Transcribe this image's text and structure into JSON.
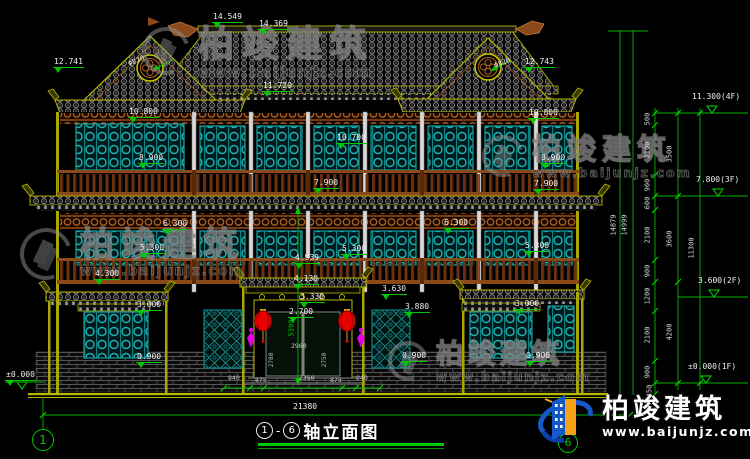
{
  "palette": {
    "background": "#000000",
    "line_green": "#00c800",
    "line_olive": "#b8b800",
    "text_white": "#ffffff",
    "window_teal": "#1db4b4",
    "wood_brown": "#8a4a1a",
    "lantern_red": "#e60000",
    "ornament_magenta": "#e000e0",
    "logo_blue": "#1558c8",
    "logo_orange": "#f5a21a"
  },
  "title": {
    "axis_start": "1",
    "separator": "-",
    "axis_end": "6",
    "label": "轴立面图"
  },
  "axes": {
    "left_label": "1",
    "right_label": "6"
  },
  "watermark": {
    "brand": "柏竣建筑",
    "url": "www.baijunjz.com"
  },
  "logo": {
    "brand": "柏竣建筑",
    "url": "www.baijunjz.com"
  },
  "annotations": [
    {
      "name": "dim-14549",
      "text": "14.549",
      "x": 212,
      "y": 13,
      "cls": "lvl"
    },
    {
      "name": "dim-14369",
      "text": "14.369",
      "x": 258,
      "y": 20,
      "cls": "lvl"
    },
    {
      "name": "dim-12741",
      "text": "12.741",
      "x": 53,
      "y": 58,
      "cls": "lvl"
    },
    {
      "name": "dim-phi820-left",
      "text": "Φ820",
      "x": 128,
      "y": 58,
      "cls": "rot20"
    },
    {
      "name": "dim-phi820-right",
      "text": "Φ820",
      "x": 494,
      "y": 60,
      "cls": "rot20"
    },
    {
      "name": "dim-12743",
      "text": "12.743",
      "x": 524,
      "y": 58,
      "cls": "lvl"
    },
    {
      "name": "dim-11720",
      "text": "11.720",
      "x": 262,
      "y": 82,
      "cls": "lvl"
    },
    {
      "name": "dim-10800-left",
      "text": "10.800",
      "x": 128,
      "y": 108,
      "cls": "lvl"
    },
    {
      "name": "dim-10700",
      "text": "10.700",
      "x": 336,
      "y": 134,
      "cls": "lvl"
    },
    {
      "name": "dim-10800-right",
      "text": "10.800",
      "x": 528,
      "y": 109,
      "cls": "lvl"
    },
    {
      "name": "dim-8900-left",
      "text": "8.900",
      "x": 138,
      "y": 154,
      "cls": "lvl"
    },
    {
      "name": "dim-8900-right",
      "text": "8.900",
      "x": 540,
      "y": 154,
      "cls": "lvl"
    },
    {
      "name": "dim-7900-left",
      "text": "7.900",
      "x": 313,
      "y": 179,
      "cls": "lvl"
    },
    {
      "name": "dim-7900-right",
      "text": "7.900",
      "x": 533,
      "y": 180,
      "cls": "lvl"
    },
    {
      "name": "dim-6300-left",
      "text": "6.300",
      "x": 162,
      "y": 220,
      "cls": "lvl"
    },
    {
      "name": "dim-6300-right",
      "text": "6.300",
      "x": 443,
      "y": 219,
      "cls": "lvl"
    },
    {
      "name": "dim-5300-left",
      "text": "5.300",
      "x": 139,
      "y": 244,
      "cls": "lvl"
    },
    {
      "name": "dim-5300-center",
      "text": "5.300",
      "x": 341,
      "y": 245,
      "cls": "lvl"
    },
    {
      "name": "dim-5300-right",
      "text": "5.300",
      "x": 524,
      "y": 242,
      "cls": "lvl"
    },
    {
      "name": "dim-4939",
      "text": "4.939",
      "x": 294,
      "y": 254,
      "cls": "lvl"
    },
    {
      "name": "dim-4300",
      "text": "4.300",
      "x": 94,
      "y": 270,
      "cls": "lvl"
    },
    {
      "name": "dim-4130",
      "text": "4.130",
      "x": 293,
      "y": 275,
      "cls": "lvl"
    },
    {
      "name": "dim-3630",
      "text": "3.630",
      "x": 381,
      "y": 285,
      "cls": "lvl"
    },
    {
      "name": "dim-3330",
      "text": "3.330",
      "x": 299,
      "y": 293,
      "cls": "lvl"
    },
    {
      "name": "dim-3880",
      "text": "3.880",
      "x": 404,
      "y": 303,
      "cls": "lvl"
    },
    {
      "name": "dim-2700",
      "text": "2.700",
      "x": 288,
      "y": 308,
      "cls": "lvl"
    },
    {
      "name": "dim-3000-left",
      "text": "3.000",
      "x": 136,
      "y": 301,
      "cls": "lvl"
    },
    {
      "name": "dim-3000-right",
      "text": "3.000",
      "x": 514,
      "y": 300,
      "cls": "lvl"
    },
    {
      "name": "dim-0900-left",
      "text": "0.900",
      "x": 136,
      "y": 353,
      "cls": "lvl"
    },
    {
      "name": "dim-0900-mid",
      "text": "0.900",
      "x": 401,
      "y": 352,
      "cls": "lvl"
    },
    {
      "name": "dim-0900-right",
      "text": "0.900",
      "x": 525,
      "y": 352,
      "cls": "lvl"
    },
    {
      "name": "dim-pm0000-left",
      "text": "±0.000",
      "x": 5,
      "y": 371,
      "cls": "lvl"
    },
    {
      "name": "dim-21380",
      "text": "21380",
      "x": 293,
      "y": 403,
      "cls": "dim"
    },
    {
      "name": "level-4f",
      "text": "11.300(4F)",
      "x": 692,
      "y": 93,
      "cls": "dim"
    },
    {
      "name": "level-3f",
      "text": "7.800(3F)",
      "x": 696,
      "y": 176,
      "cls": "dim"
    },
    {
      "name": "level-2f",
      "text": "3.600(2F)",
      "x": 698,
      "y": 277,
      "cls": "dim"
    },
    {
      "name": "level-1f",
      "text": "±0.000(1F)",
      "x": 688,
      "y": 363,
      "cls": "dim"
    },
    {
      "name": "seg-500",
      "text": "500",
      "x": 648,
      "y": 119,
      "cls": "rotv"
    },
    {
      "name": "seg-2100-a",
      "text": "2100",
      "x": 648,
      "y": 150,
      "cls": "rotv"
    },
    {
      "name": "seg-900-a",
      "text": "900",
      "x": 648,
      "y": 185,
      "cls": "rotv"
    },
    {
      "name": "seg-600",
      "text": "600",
      "x": 648,
      "y": 203,
      "cls": "rotv"
    },
    {
      "name": "seg-2100-b",
      "text": "2100",
      "x": 648,
      "y": 235,
      "cls": "rotv"
    },
    {
      "name": "seg-900-b",
      "text": "900",
      "x": 648,
      "y": 271,
      "cls": "rotv"
    },
    {
      "name": "seg-1200",
      "text": "1200",
      "x": 648,
      "y": 296,
      "cls": "rotv"
    },
    {
      "name": "seg-2100-c",
      "text": "2100",
      "x": 648,
      "y": 335,
      "cls": "rotv"
    },
    {
      "name": "seg-900-c",
      "text": "900",
      "x": 648,
      "y": 372,
      "cls": "rotv"
    },
    {
      "name": "seg-450",
      "text": "450",
      "x": 650,
      "y": 391,
      "cls": "rotv"
    },
    {
      "name": "seg-3500",
      "text": "3500",
      "x": 670,
      "y": 154,
      "cls": "rotv"
    },
    {
      "name": "seg-3600",
      "text": "3600",
      "x": 670,
      "y": 239,
      "cls": "rotv"
    },
    {
      "name": "seg-4200",
      "text": "4200",
      "x": 670,
      "y": 332,
      "cls": "rotv"
    },
    {
      "name": "seg-11300",
      "text": "11300",
      "x": 692,
      "y": 248,
      "cls": "rotv"
    },
    {
      "name": "total-14879",
      "text": "14879",
      "x": 614,
      "y": 225,
      "cls": "rotv"
    },
    {
      "name": "total-14999",
      "text": "14999",
      "x": 625,
      "y": 225,
      "cls": "rotv"
    },
    {
      "name": "dim-5399",
      "text": "5399",
      "x": 292,
      "y": 328,
      "cls": "grnrot"
    },
    {
      "name": "dim-2960",
      "text": "2960",
      "x": 291,
      "y": 343,
      "cls": "tiny"
    },
    {
      "name": "dim-2780",
      "text": "2780",
      "x": 272,
      "y": 360,
      "cls": "tinyrot"
    },
    {
      "name": "dim-2750",
      "text": "2750",
      "x": 325,
      "y": 360,
      "cls": "tinyrot"
    },
    {
      "name": "dim-940-left",
      "text": "940",
      "x": 228,
      "y": 375,
      "cls": "tiny"
    },
    {
      "name": "dim-875-left",
      "text": "875",
      "x": 255,
      "y": 377,
      "cls": "tiny"
    },
    {
      "name": "dim-2350",
      "text": "2350",
      "x": 299,
      "y": 375,
      "cls": "tiny"
    },
    {
      "name": "dim-875-right",
      "text": "875",
      "x": 330,
      "y": 377,
      "cls": "tiny"
    },
    {
      "name": "dim-940-right",
      "text": "940",
      "x": 356,
      "y": 375,
      "cls": "tiny"
    }
  ]
}
